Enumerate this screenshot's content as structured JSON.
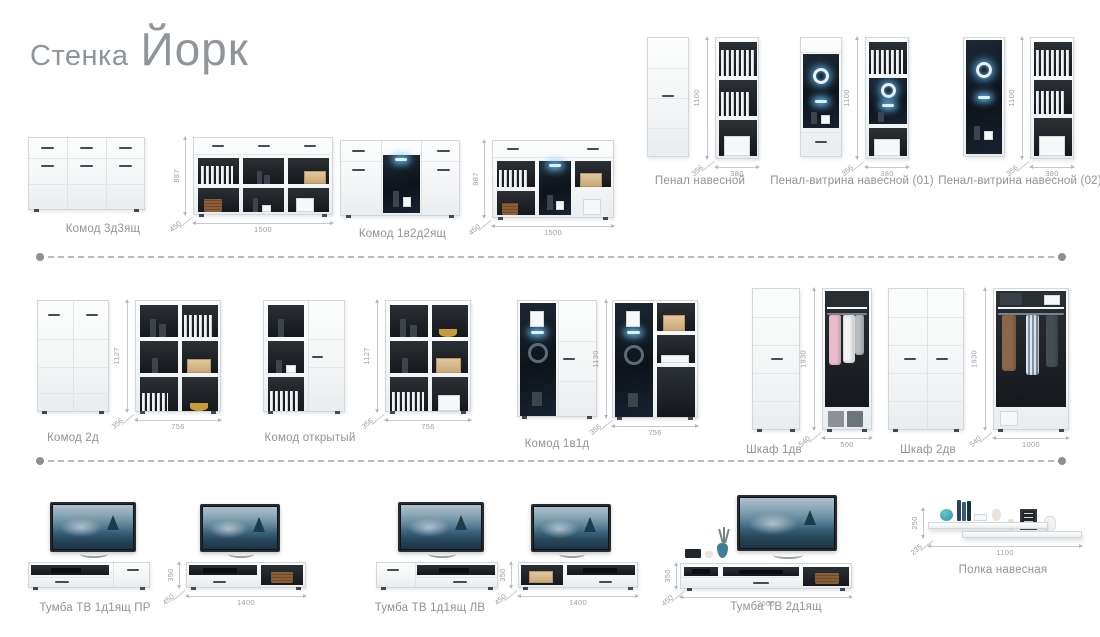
{
  "title": {
    "prefix": "Стенка",
    "name": "Йорк"
  },
  "colors": {
    "led_glow": "#5ec0ff",
    "label_text": "#8d9398",
    "dimension_text": "#999fa4"
  },
  "products": [
    {
      "name": "Комод 3д3ящ",
      "height": "887",
      "depth": "450",
      "width": "1500"
    },
    {
      "name": "Комод 1в2д2ящ",
      "height": "887",
      "depth": "450",
      "width": "1500"
    },
    {
      "name": "Пенал навесной",
      "height": "1100",
      "depth": "356",
      "width": "380"
    },
    {
      "name": "Пенал-витрина навесной (01)",
      "height": "1100",
      "depth": "356",
      "width": "380"
    },
    {
      "name": "Пенал-витрина навесной (02)",
      "height": "1100",
      "depth": "356",
      "width": "380"
    },
    {
      "name": "Комод 2д",
      "height": "1127",
      "depth": "356",
      "width": "756"
    },
    {
      "name": "Комод открытый",
      "height": "1127",
      "depth": "356",
      "width": "756"
    },
    {
      "name": "Комод 1в1д",
      "height": "1130",
      "depth": "356",
      "width": "756"
    },
    {
      "name": "Шкаф 1дв",
      "height": "1930",
      "depth": "540",
      "width": "500"
    },
    {
      "name": "Шкаф 2дв",
      "height": "1930",
      "depth": "540",
      "width": "1000"
    },
    {
      "name": "Тумба ТВ 1д1ящ ПР",
      "height": "350",
      "depth": "450",
      "width": "1400"
    },
    {
      "name": "Тумба ТВ 1д1ящ ЛВ",
      "height": "350",
      "depth": "450",
      "width": "1400"
    },
    {
      "name": "Тумба ТВ 2д1ящ",
      "height": "350",
      "depth": "450",
      "width": "2000"
    },
    {
      "name": "Полка навесная",
      "height": "250",
      "depth": "235",
      "width": "1100"
    }
  ]
}
